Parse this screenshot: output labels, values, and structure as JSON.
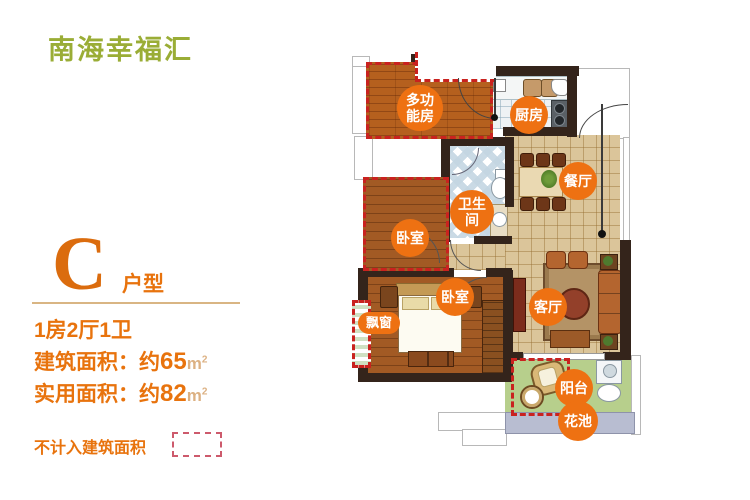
{
  "brand": {
    "logo_text": "南海幸福汇"
  },
  "unit": {
    "letter": "C",
    "type_label": "户型"
  },
  "specs": {
    "rooms_summary": "1房2厅1卫",
    "built_area_label": "建筑面积：约",
    "built_area_value": "65",
    "usable_area_label": "实用面积：约",
    "usable_area_value": "82",
    "area_unit": "m",
    "area_unit_sup": "2"
  },
  "legend": {
    "excluded_note": "不计入建筑面积"
  },
  "floorplan": {
    "rooms": {
      "multi_line1": "多功",
      "multi_line2": "能房",
      "kitchen": "厨房",
      "dining": "餐厅",
      "bath_line1": "卫生",
      "bath_line2": "间",
      "bedroom_small": "卧室",
      "bedroom_main": "卧室",
      "living": "客厅",
      "bay_window": "飘窗",
      "balcony": "阳台",
      "flower_bed": "花池"
    }
  },
  "colors": {
    "accent_orange": "#ee7112",
    "logo_green": "#9aad36",
    "dashed_red": "#c9221f",
    "wall_dark": "#34241b"
  }
}
